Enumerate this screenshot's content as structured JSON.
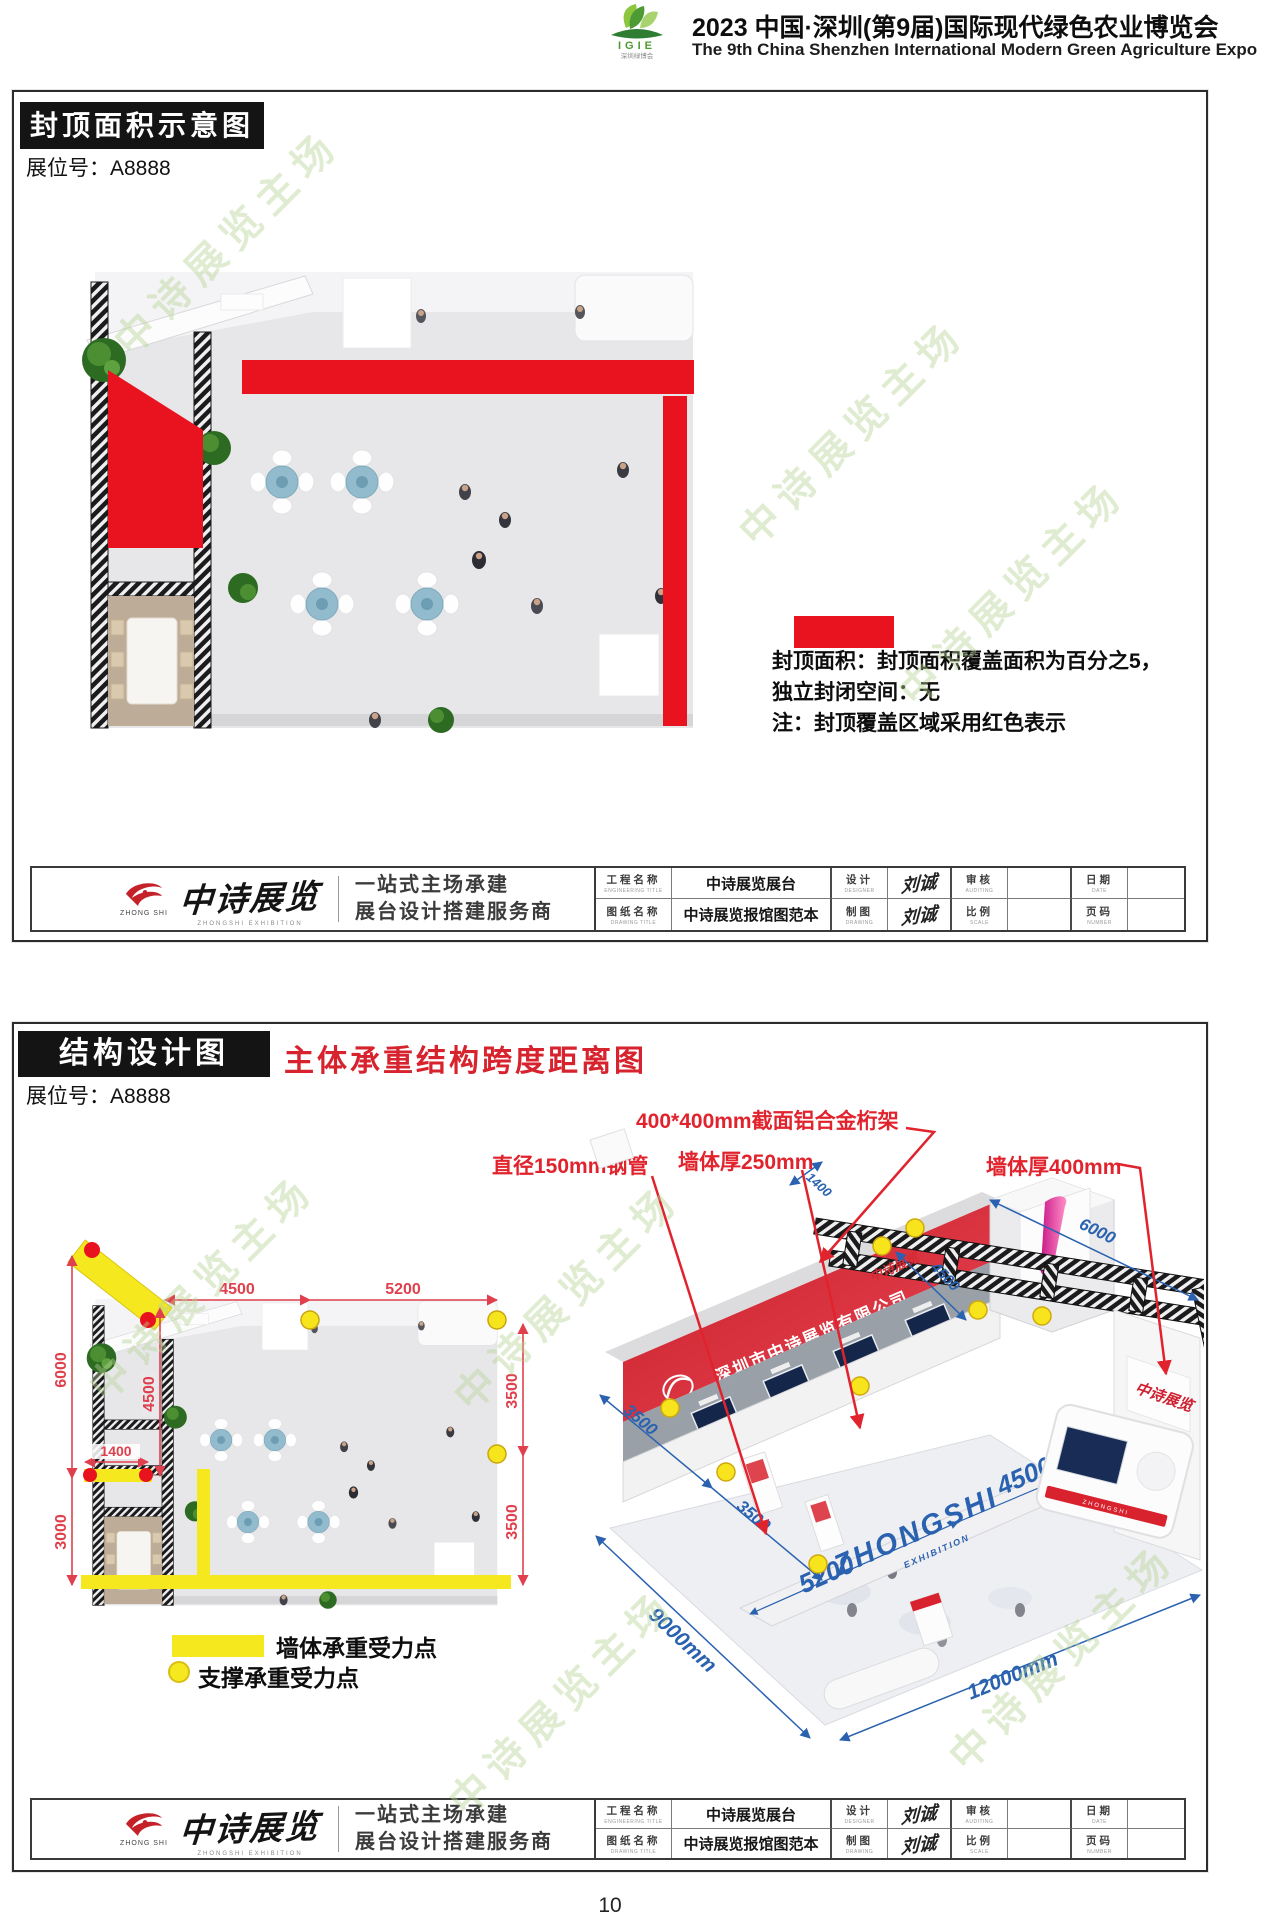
{
  "header": {
    "logo_acronym": "IGIE",
    "logo_caption": "深圳绿博会",
    "title_cn": "2023 中国·深圳(第9届)国际现代绿色农业博览会",
    "title_en": "The 9th China Shenzhen International Modern Green Agriculture Expo"
  },
  "panel1": {
    "title": "封顶面积示意图",
    "booth_label": "展位号：A8888",
    "legend": {
      "line1": "封顶面积：封顶面积覆盖面积为百分之5，",
      "line2": "独立封闭空间：无",
      "line3": "注：封顶覆盖区域采用红色表示"
    }
  },
  "panel2": {
    "title": "结构设计图",
    "subtitle": "主体承重结构跨度距离图",
    "booth_label": "展位号：A8888",
    "annotations": {
      "truss": "400*400mm截面铝合金桁架",
      "pipe": "直径150mm钢管",
      "wall250": "墙体厚250mm",
      "wall400": "墙体厚400mm"
    },
    "plan_dims": {
      "v6000": "6000",
      "v3000": "3000",
      "h4500": "4500",
      "h5200": "5200",
      "v4500": "4500",
      "h1400": "1400",
      "v3500a": "3500",
      "v3500b": "3500"
    },
    "iso": {
      "company": "深圳市中诗展览有限公司",
      "logo_text": "ZHONG SHI",
      "edge3500a": "3500",
      "edge3500b": "3500",
      "d1400": "1400",
      "d6000": "6000",
      "d4500_small": "4500",
      "band4500": "4500",
      "brand": "ZHONGSHI",
      "brand_sub": "EXHIBITION",
      "band5200": "5200",
      "bottom_left": "9000mm",
      "bottom_right": "12000mm",
      "flag": "中诗展览",
      "wall_sign": "中诗展览",
      "kiosk": "ZHONGSHI"
    },
    "legend": {
      "wall": "墙体承重受力点",
      "support": "支撑承重受力点"
    }
  },
  "titleblock": {
    "logo_text": "ZHONG SHI",
    "brand": "中诗展览",
    "brand_sub": "ZHONGSHI EXHIBITION",
    "slogan1": "一站式主场承建",
    "slogan2": "展台设计搭建服务商",
    "cells": {
      "c1": {
        "cn": "工程名称",
        "en": "ENGINEERING TITLE",
        "value": "中诗展览展台"
      },
      "c2": {
        "cn": "设计",
        "en": "DESIGNER",
        "value": "刘诚"
      },
      "c3": {
        "cn": "审核",
        "en": "AUDITING",
        "value": ""
      },
      "c4": {
        "cn": "日期",
        "en": "DATE",
        "value": ""
      },
      "c5": {
        "cn": "图纸名称",
        "en": "DRAWING TITLE",
        "value": "中诗展览报馆图范本"
      },
      "c6": {
        "cn": "制图",
        "en": "DRAWING",
        "value": "刘诚"
      },
      "c7": {
        "cn": "比例",
        "en": "SCALE",
        "value": ""
      },
      "c8": {
        "cn": "页码",
        "en": "NUMBER",
        "value": ""
      }
    }
  },
  "watermark": "中诗展览主场",
  "page_number": "10",
  "colors": {
    "roof_red": "#e8131f",
    "support_yellow": "#f6e81e",
    "dim_red": "#e0404d",
    "dim_blue": "#2a62b0",
    "banner_red": "#d8232f"
  }
}
